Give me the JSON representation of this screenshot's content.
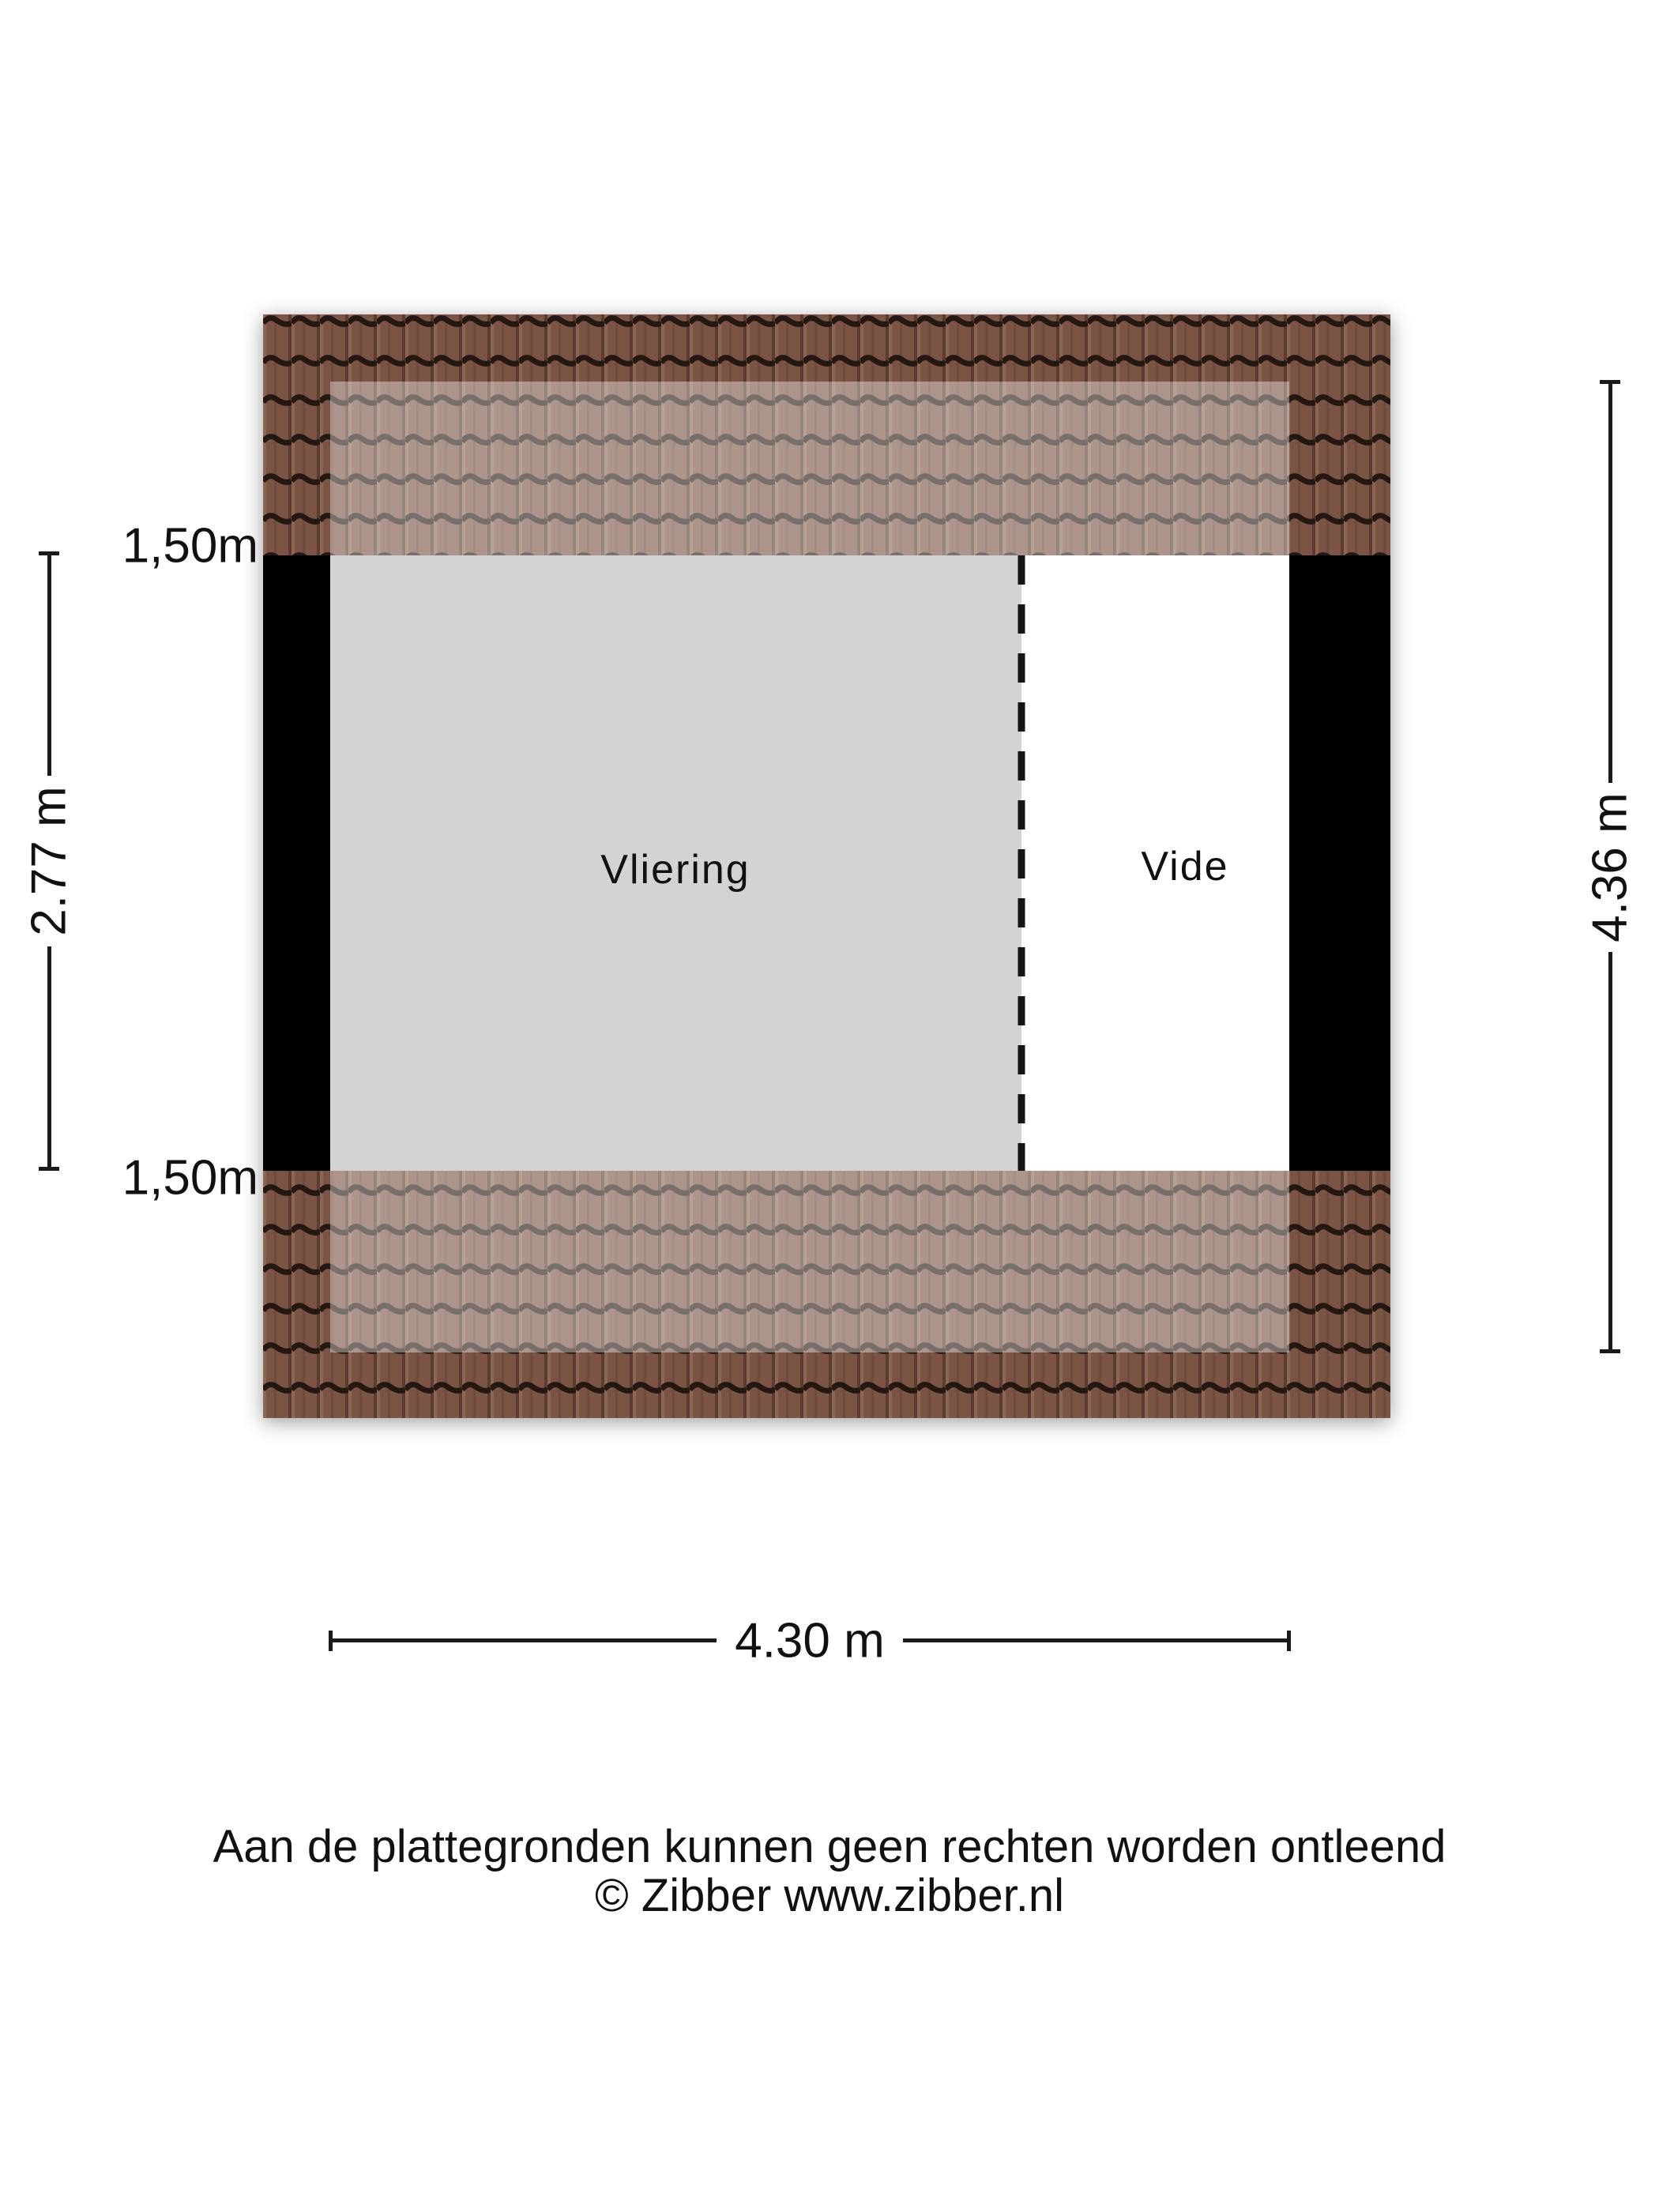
{
  "floorplan": {
    "rooms": [
      {
        "name": "vliering",
        "label": "Vliering"
      },
      {
        "name": "vide",
        "label": "Vide"
      }
    ],
    "clearance_labels": {
      "top": "1,50m",
      "bottom": "1,50m"
    },
    "dimensions": {
      "inner_height": "2.77 m",
      "outer_height": "4.36 m",
      "width": "4.30 m"
    },
    "colors": {
      "roof_tile_body": "#7b5444",
      "roof_tile_line": "#241812",
      "roof_tile_highlight": "#8e6654",
      "wall": "#000000",
      "vliering_fill": "#d3d3d3",
      "vide_fill": "#ffffff",
      "dimension_line": "#1a1a1a"
    }
  },
  "footer": {
    "line1": "Aan de plattegronden kunnen geen rechten worden ontleend",
    "line2": "© Zibber www.zibber.nl"
  }
}
